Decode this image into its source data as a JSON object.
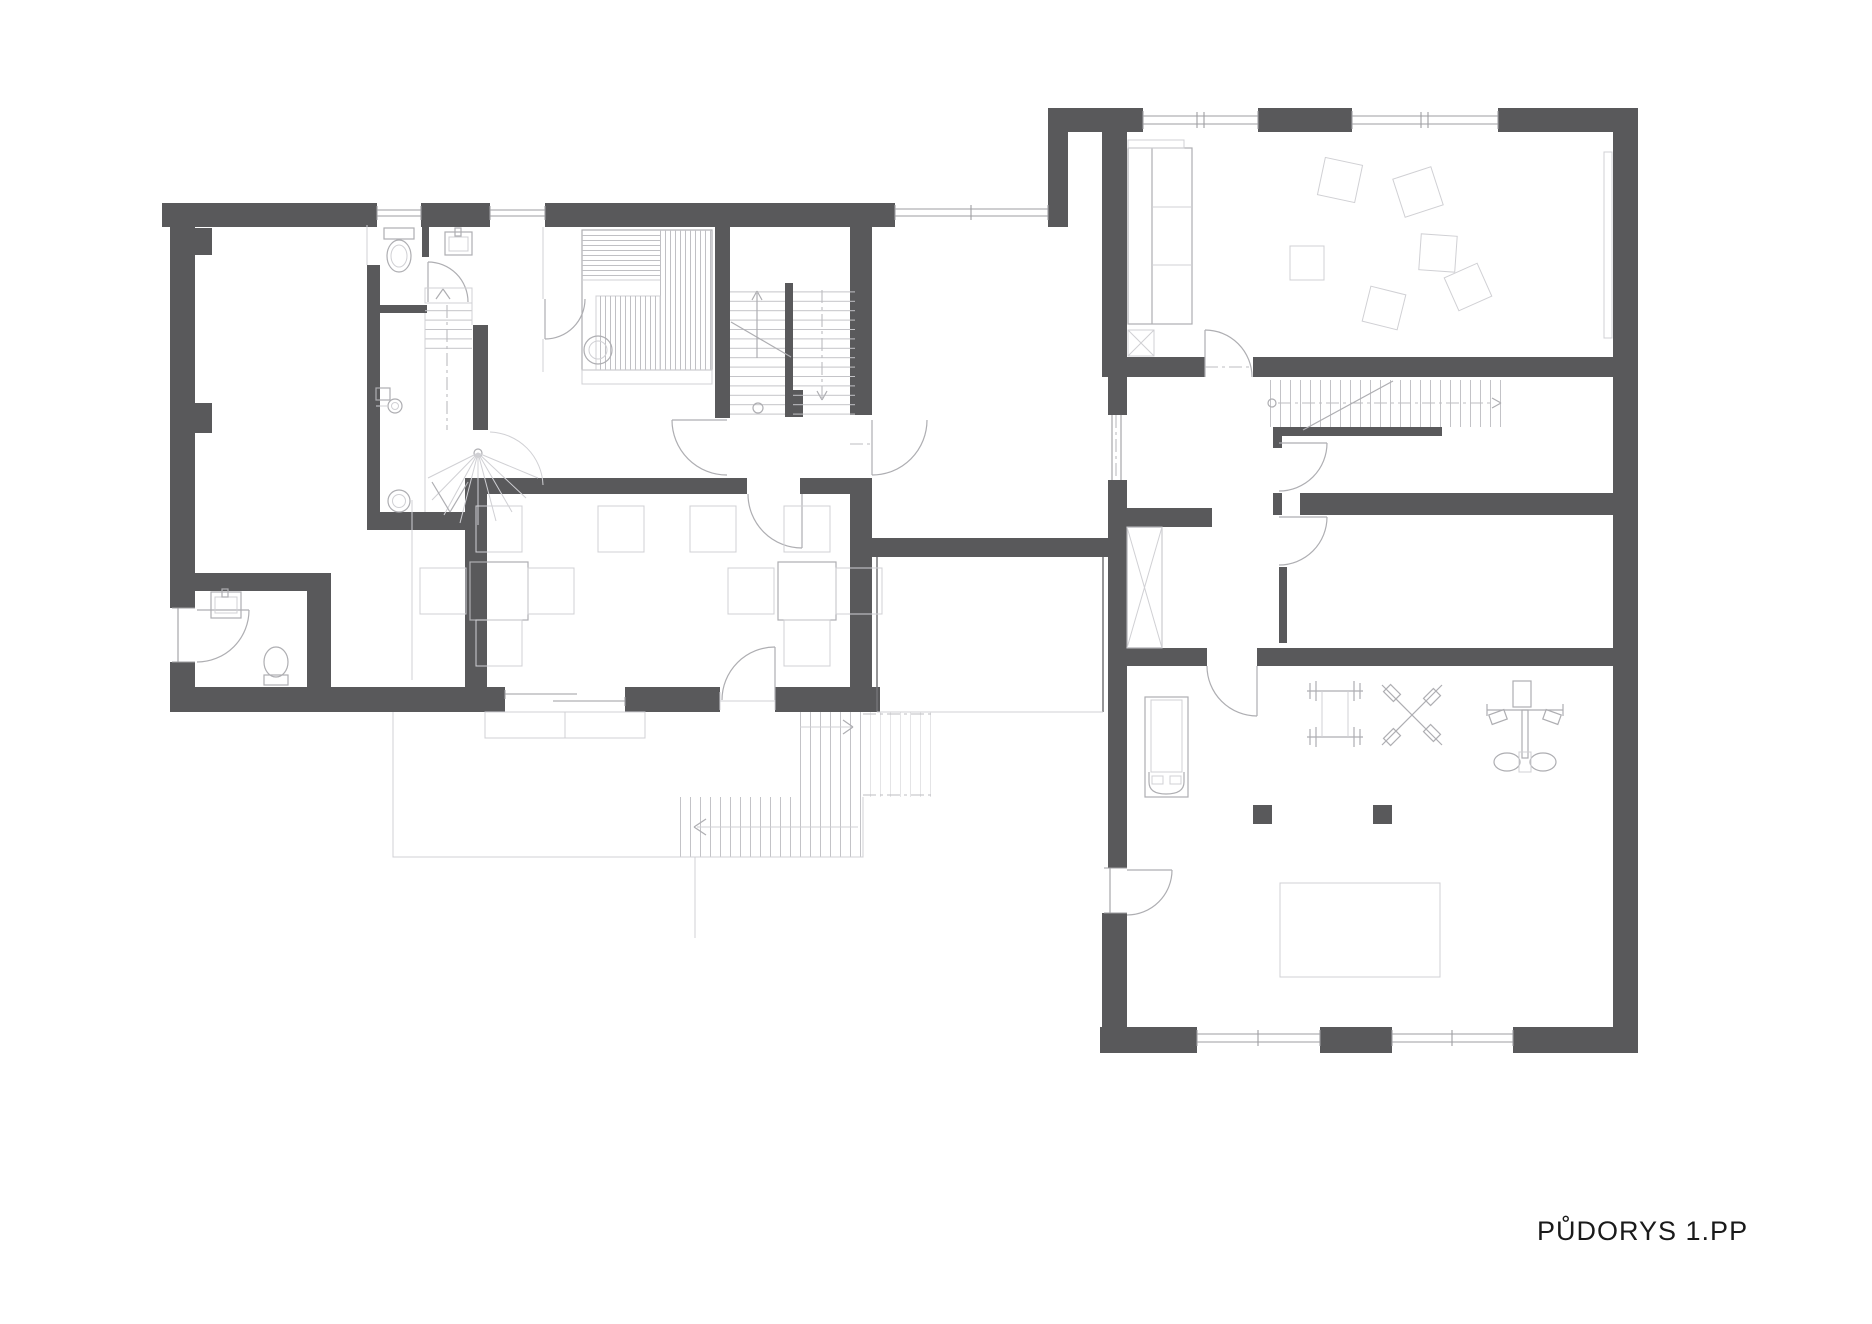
{
  "title": {
    "label": "PŮDORYS 1.PP"
  },
  "drawing": {
    "colors": {
      "walls": "#59595b",
      "furniture_lines": "#aeaeb2",
      "faint_lines": "#d0d0d4",
      "glazing_lines": "#9e9ea2",
      "background": "#ffffff",
      "title_text": "#1a1a1a"
    }
  }
}
